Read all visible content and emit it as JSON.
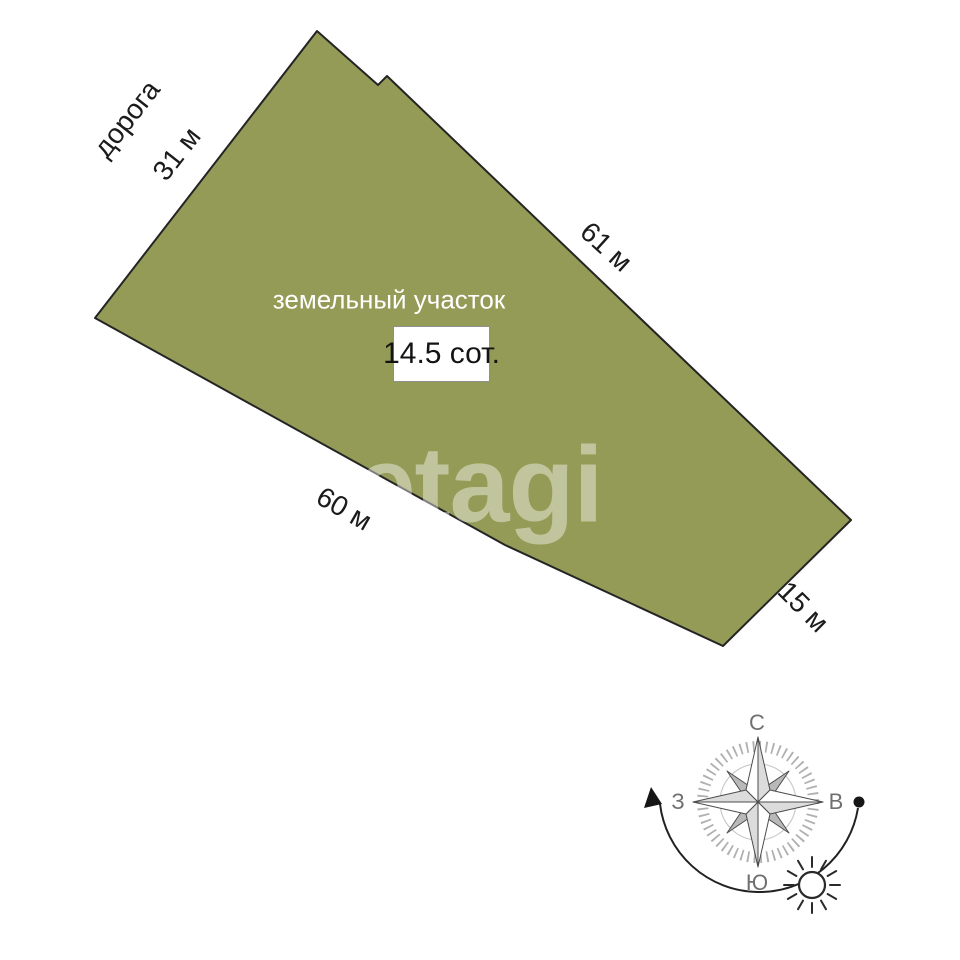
{
  "colors": {
    "page_bg": "#ffffff",
    "plot_fill": "#949B56",
    "plot_stroke": "#242424",
    "label_text": "#1b1b1b",
    "plot_name_text": "#ffffff",
    "compass_letter": "#707070"
  },
  "plot": {
    "name_label": "земельный участок",
    "area_label": "14.5 сот.",
    "road_label": "дорога",
    "polygon_points": "317,31 378,85 387,76 851,520 723,646 505,545 95,318",
    "dimensions": [
      {
        "side": "top-left",
        "label": "31 м"
      },
      {
        "side": "top-right",
        "label": "61 м"
      },
      {
        "side": "bottom-left",
        "label": "60 м"
      },
      {
        "side": "bottom-right",
        "label": "15 м"
      }
    ]
  },
  "watermark": {
    "text": "etagi"
  },
  "compass": {
    "north_label": "С",
    "east_label": "В",
    "south_label": "Ю",
    "west_label": "З"
  }
}
